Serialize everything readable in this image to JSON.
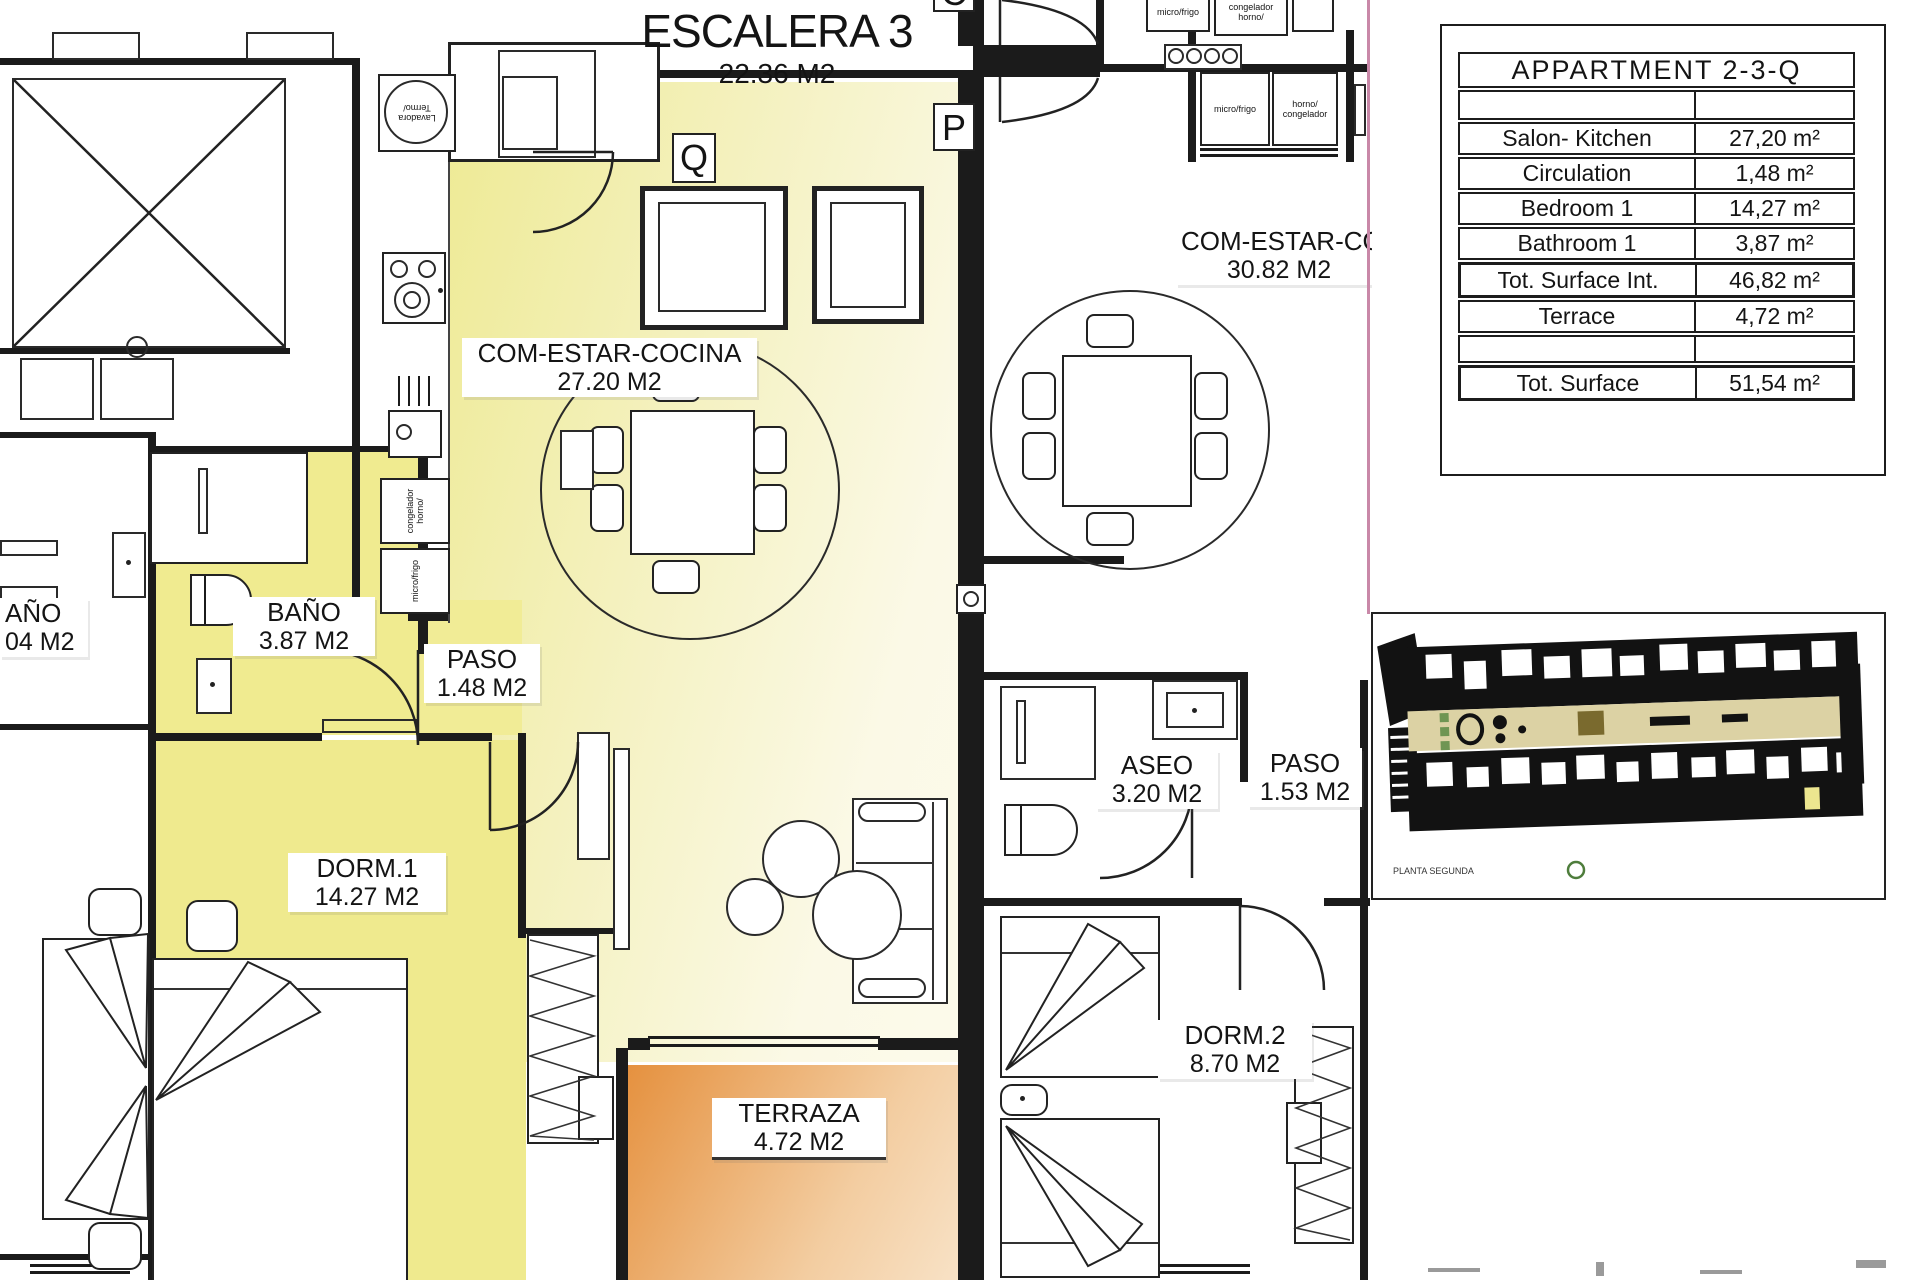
{
  "plan": {
    "stair_title": "ESCALERA 3",
    "stair_area": "22.36 M2",
    "markers": {
      "q": "Q",
      "p": "P",
      "c": "C"
    },
    "rooms": {
      "salon_q": {
        "name": "COM-ESTAR-COCINA",
        "area": "27.20 M2"
      },
      "bano_q": {
        "name": "BAÑO",
        "area": "3.87 M2"
      },
      "paso_q": {
        "name": "PASO",
        "area": "1.48 M2"
      },
      "dorm1": {
        "name": "DORM.1",
        "area": "14.27 M2"
      },
      "terraza": {
        "name": "TERRAZA",
        "area": "4.72 M2"
      },
      "salon_p": {
        "name": "COM-ESTAR-COC",
        "area": "30.82 M2"
      },
      "aseo": {
        "name": "ASEO",
        "area": "3.20 M2"
      },
      "paso_p": {
        "name": "PASO",
        "area": "1.53 M2"
      },
      "dorm2": {
        "name": "DORM.2",
        "area": "8.70 M2"
      },
      "bano_left": {
        "name": "AÑO",
        "area": "04 M2"
      }
    },
    "appliances": {
      "lavadora": "Lavadora\nTermo/",
      "congelador_q": "congelador\nhorno/",
      "micro_q": "micro/frigo",
      "micro_p_top": "micro/frigo",
      "congelador_p_top": "congelador\nhorno/",
      "micro_p": "micro/frigo",
      "horno_p": "horno/\ncongelador"
    }
  },
  "area_table": {
    "title": "APPARTMENT 2-3-Q",
    "rows": [
      {
        "label": "",
        "value": ""
      },
      {
        "label": "Salon- Kitchen",
        "value": "27,20 m²"
      },
      {
        "label": "Circulation",
        "value": "1,48 m²"
      },
      {
        "label": "Bedroom 1",
        "value": "14,27 m²"
      },
      {
        "label": "Bathroom 1",
        "value": "3,87 m²"
      },
      {
        "label": "Tot. Surface Int.",
        "value": "46,82 m²"
      },
      {
        "label": "Terrace",
        "value": "4,72 m²"
      },
      {
        "label": "",
        "value": ""
      },
      {
        "label": "Tot. Surface",
        "value": "51,54 m²"
      }
    ]
  },
  "site_plan": {
    "caption": "PLANTA SEGUNDA"
  }
}
